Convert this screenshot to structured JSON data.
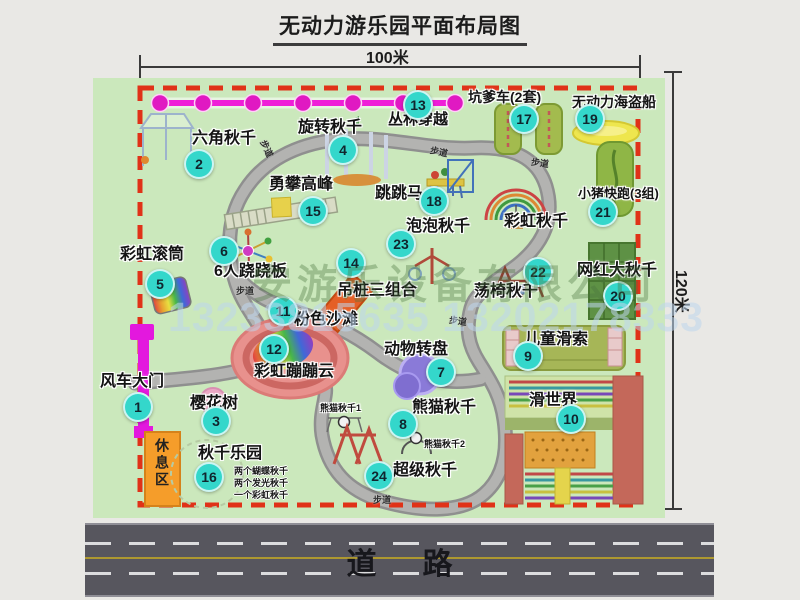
{
  "title": "无动力游乐园平面布局图",
  "dimensions": {
    "width_label": "100米",
    "height_label": "120米"
  },
  "road": {
    "label": "道路"
  },
  "rest_area": {
    "label": "休息区"
  },
  "watermark": {
    "company": "安游乐设备有限公司",
    "phone": "13233815635 13202178333"
  },
  "colors": {
    "map_green": "#cbe8bc",
    "border_red": "#e03218",
    "badge_teal": "#34d7cb",
    "jungle_magenta": "#ef1ed8",
    "gate_magenta": "#e318de",
    "rest_orange": "#f59d2a",
    "road_gray": "#57565e",
    "walkway_gray": "#b3b3b1"
  },
  "attractions": [
    {
      "num": "1",
      "label": "风车大门",
      "badge": {
        "x": 138,
        "y": 407
      },
      "label_pos": {
        "x": 100,
        "y": 374
      }
    },
    {
      "num": "2",
      "label": "六角秋千",
      "badge": {
        "x": 199,
        "y": 164
      },
      "label_pos": {
        "x": 192,
        "y": 131
      }
    },
    {
      "num": "3",
      "label": "樱花树",
      "badge": {
        "x": 216,
        "y": 421
      },
      "label_pos": {
        "x": 190,
        "y": 396
      }
    },
    {
      "num": "4",
      "label": "旋转秋千",
      "badge": {
        "x": 343,
        "y": 150
      },
      "label_pos": {
        "x": 298,
        "y": 120
      }
    },
    {
      "num": "5",
      "label": "彩虹滚筒",
      "badge": {
        "x": 160,
        "y": 284
      },
      "label_pos": {
        "x": 120,
        "y": 247
      }
    },
    {
      "num": "6",
      "label": "6人跷跷板",
      "badge": {
        "x": 224,
        "y": 251
      },
      "label_pos": {
        "x": 214,
        "y": 264
      }
    },
    {
      "num": "7",
      "label": "动物转盘",
      "badge": {
        "x": 441,
        "y": 372
      },
      "label_pos": {
        "x": 384,
        "y": 342
      }
    },
    {
      "num": "8",
      "label": "熊猫秋千",
      "badge": {
        "x": 403,
        "y": 424
      },
      "label_pos": {
        "x": 412,
        "y": 400
      }
    },
    {
      "num": "9",
      "label": "儿童滑索",
      "badge": {
        "x": 528,
        "y": 356
      },
      "label_pos": {
        "x": 524,
        "y": 332
      }
    },
    {
      "num": "10",
      "label": "滑世界",
      "badge": {
        "x": 571,
        "y": 419
      },
      "label_pos": {
        "x": 529,
        "y": 393
      }
    },
    {
      "num": "11",
      "label": "粉色沙滩",
      "badge": {
        "x": 283,
        "y": 311
      },
      "label_pos": {
        "x": 294,
        "y": 312
      }
    },
    {
      "num": "12",
      "label": "彩虹蹦蹦云",
      "badge": {
        "x": 274,
        "y": 349
      },
      "label_pos": {
        "x": 254,
        "y": 364
      }
    },
    {
      "num": "13",
      "label": "丛林穿越",
      "badge": {
        "x": 418,
        "y": 105
      },
      "label_pos": {
        "x": 388,
        "y": 112
      },
      "size": 15
    },
    {
      "num": "14",
      "label": "吊桩三组合",
      "badge": {
        "x": 351,
        "y": 263
      },
      "label_pos": {
        "x": 337,
        "y": 283
      }
    },
    {
      "num": "15",
      "label": "勇攀高峰",
      "badge": {
        "x": 313,
        "y": 211
      },
      "label_pos": {
        "x": 269,
        "y": 177
      }
    },
    {
      "num": "16",
      "label": "秋千乐园",
      "badge": {
        "x": 209,
        "y": 477
      },
      "label_pos": {
        "x": 198,
        "y": 446
      }
    },
    {
      "num": "17",
      "label": "坑爹车(2套)",
      "badge": {
        "x": 524,
        "y": 119
      },
      "label_pos": {
        "x": 468,
        "y": 90
      },
      "size": 14
    },
    {
      "num": "18",
      "label": "跳跳马",
      "badge": {
        "x": 434,
        "y": 201
      },
      "label_pos": {
        "x": 375,
        "y": 186
      }
    },
    {
      "num": "19",
      "label": "无动力海盗船",
      "badge": {
        "x": 590,
        "y": 119
      },
      "label_pos": {
        "x": 572,
        "y": 95
      },
      "size": 14
    },
    {
      "num": "20",
      "label": "网红大秋千",
      "badge": {
        "x": 618,
        "y": 296
      },
      "label_pos": {
        "x": 577,
        "y": 263
      }
    },
    {
      "num": "21",
      "label": "小猪快跑(3组)",
      "badge": {
        "x": 603,
        "y": 212
      },
      "label_pos": {
        "x": 578,
        "y": 187
      },
      "size": 13
    },
    {
      "num": "22",
      "label": "荡椅秋千",
      "badge": {
        "x": 538,
        "y": 272
      },
      "label_pos": {
        "x": 474,
        "y": 284
      }
    },
    {
      "num": "23",
      "label": "泡泡秋千",
      "badge": {
        "x": 401,
        "y": 244
      },
      "label_pos": {
        "x": 406,
        "y": 219
      }
    },
    {
      "num": "24",
      "label": "超级秋千",
      "badge": {
        "x": 379,
        "y": 476
      },
      "label_pos": {
        "x": 393,
        "y": 463
      }
    }
  ],
  "extra_labels": [
    {
      "label": "彩虹秋千",
      "x": 504,
      "y": 214,
      "size": 16
    },
    {
      "label": "熊猫秋千1",
      "x": 320,
      "y": 404,
      "size": 9
    },
    {
      "label": "熊猫秋千2",
      "x": 424,
      "y": 440,
      "size": 9
    }
  ],
  "swing_park_notes": [
    "两个蝴蝶秋千",
    "两个发光秋千",
    "一个彩虹秋千"
  ],
  "path_labels": [
    {
      "label": "步道",
      "x": 258,
      "y": 142,
      "rot": 65
    },
    {
      "label": "步道",
      "x": 430,
      "y": 145,
      "rot": 12
    },
    {
      "label": "步道",
      "x": 531,
      "y": 156,
      "rot": 8
    },
    {
      "label": "步道",
      "x": 236,
      "y": 284,
      "rot": 0
    },
    {
      "label": "步道",
      "x": 449,
      "y": 314,
      "rot": 8
    },
    {
      "label": "步道",
      "x": 373,
      "y": 493,
      "rot": 0
    }
  ]
}
